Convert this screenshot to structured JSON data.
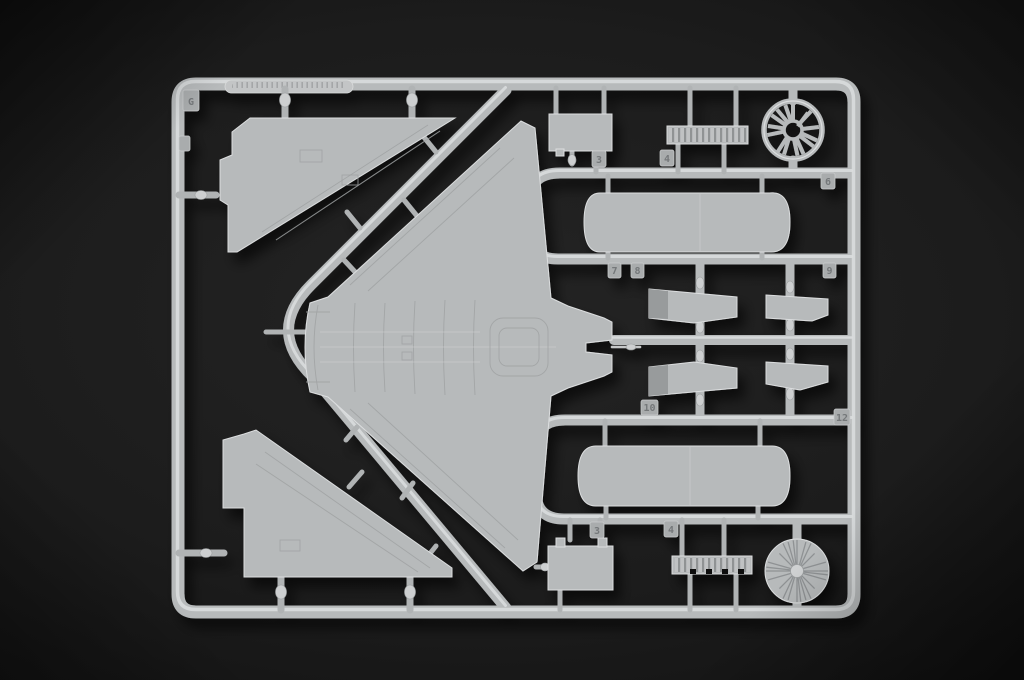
{
  "colors": {
    "bg_center": "#242424",
    "bg_edge": "#060606",
    "plastic": "#b7babb",
    "plastic_hi": "#dcdedf",
    "plastic_lo": "#8f9294",
    "tag_face": "#a9acad",
    "engraving": "#74787a"
  },
  "sprue": {
    "corner_letter": "G",
    "tags": {
      "top_panel": "3",
      "top_grille": "4",
      "upper_right": "6",
      "mid_left_a": "7",
      "mid_left_b": "8",
      "mid_right_a": "9",
      "mid_left_c": "10",
      "mid_right_b": "12",
      "bottom_panel": "3",
      "bottom_grille": "4"
    }
  }
}
